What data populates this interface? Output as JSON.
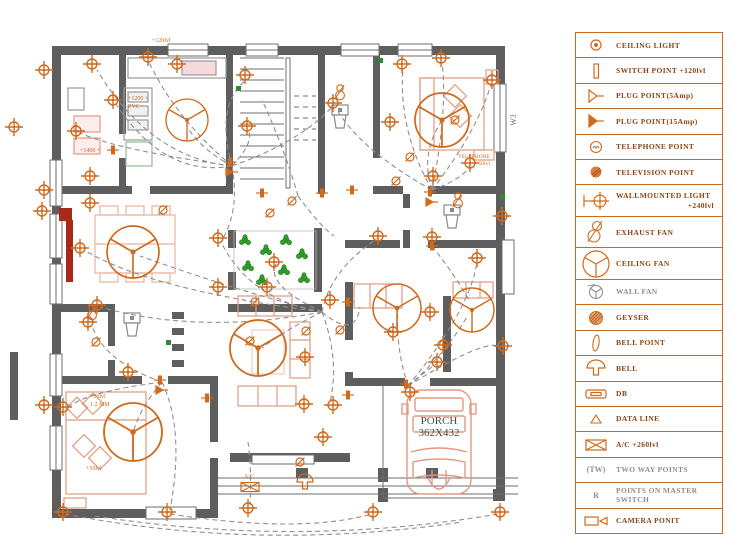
{
  "legend": {
    "items": [
      {
        "icon": "ceiling-light-icon",
        "label": "CEILING LIGHT"
      },
      {
        "icon": "switch-point-icon",
        "label": "SWITCH POINT  +120lvl"
      },
      {
        "icon": "plug-point-5amp-icon",
        "label": "PLUG POINT(5Amp)"
      },
      {
        "icon": "plug-point-15amp-icon",
        "label": "PLUG POINT(15Amp)"
      },
      {
        "icon": "telephone-point-icon",
        "label": "TELEPHONE POINT"
      },
      {
        "icon": "television-point-icon",
        "label": "TELEVISION POINT"
      },
      {
        "icon": "wallmounted-light-icon",
        "label": "WALLMOUNTED LIGHT",
        "sublabel": "+240lvl"
      },
      {
        "icon": "exhaust-fan-icon",
        "label": "EXHAUST FAN"
      },
      {
        "icon": "ceiling-fan-icon",
        "label": "CEILING FAN"
      },
      {
        "icon": "wall-fan-icon",
        "label": "WALL FAN"
      },
      {
        "icon": "geyser-icon",
        "label": "GEYSER"
      },
      {
        "icon": "bell-point-icon",
        "label": "BELL POINT"
      },
      {
        "icon": "bell-icon",
        "label": "BELL"
      },
      {
        "icon": "db-icon",
        "label": "DB"
      },
      {
        "icon": "data-line-icon",
        "label": "DATA LINE"
      },
      {
        "icon": "ac-icon",
        "label": "A/C  +260lvl"
      },
      {
        "icon": "two-way-icon",
        "label": "TWO WAY POINTS",
        "symbol": "(TW)"
      },
      {
        "icon": "master-switch-icon",
        "label": "POINTS ON MASTER SWITCH",
        "symbol": "R"
      },
      {
        "icon": "camera-icon",
        "label": "CAMERA PONIT"
      }
    ]
  },
  "plan": {
    "porch": {
      "line1": "PORCH",
      "line2": "362X432"
    },
    "labels": [
      {
        "text": "+120lvl"
      },
      {
        "text": "+1200 +"
      },
      {
        "text": "PVC +"
      },
      {
        "text": "+1400 +"
      },
      {
        "text": "TELEPHONE"
      },
      {
        "text": "+50lvl"
      },
      {
        "text": "+50lvl"
      },
      {
        "text": "1.2 MM"
      },
      {
        "text": "+50lvl"
      },
      {
        "text": "A/C"
      },
      {
        "text": "W3"
      }
    ]
  },
  "colors": {
    "symbol_orange": "#cf6a1d",
    "wall_gray": "#5e5e5e",
    "wire_gray": "#8f8f8f",
    "furniture_salmon": "#e09a80",
    "plant_green": "#33a02c",
    "door_red": "#a8281a",
    "legend_border": "#c96a1f",
    "legend_text": "#8a4613",
    "porch_text": "#4a4a4a"
  }
}
